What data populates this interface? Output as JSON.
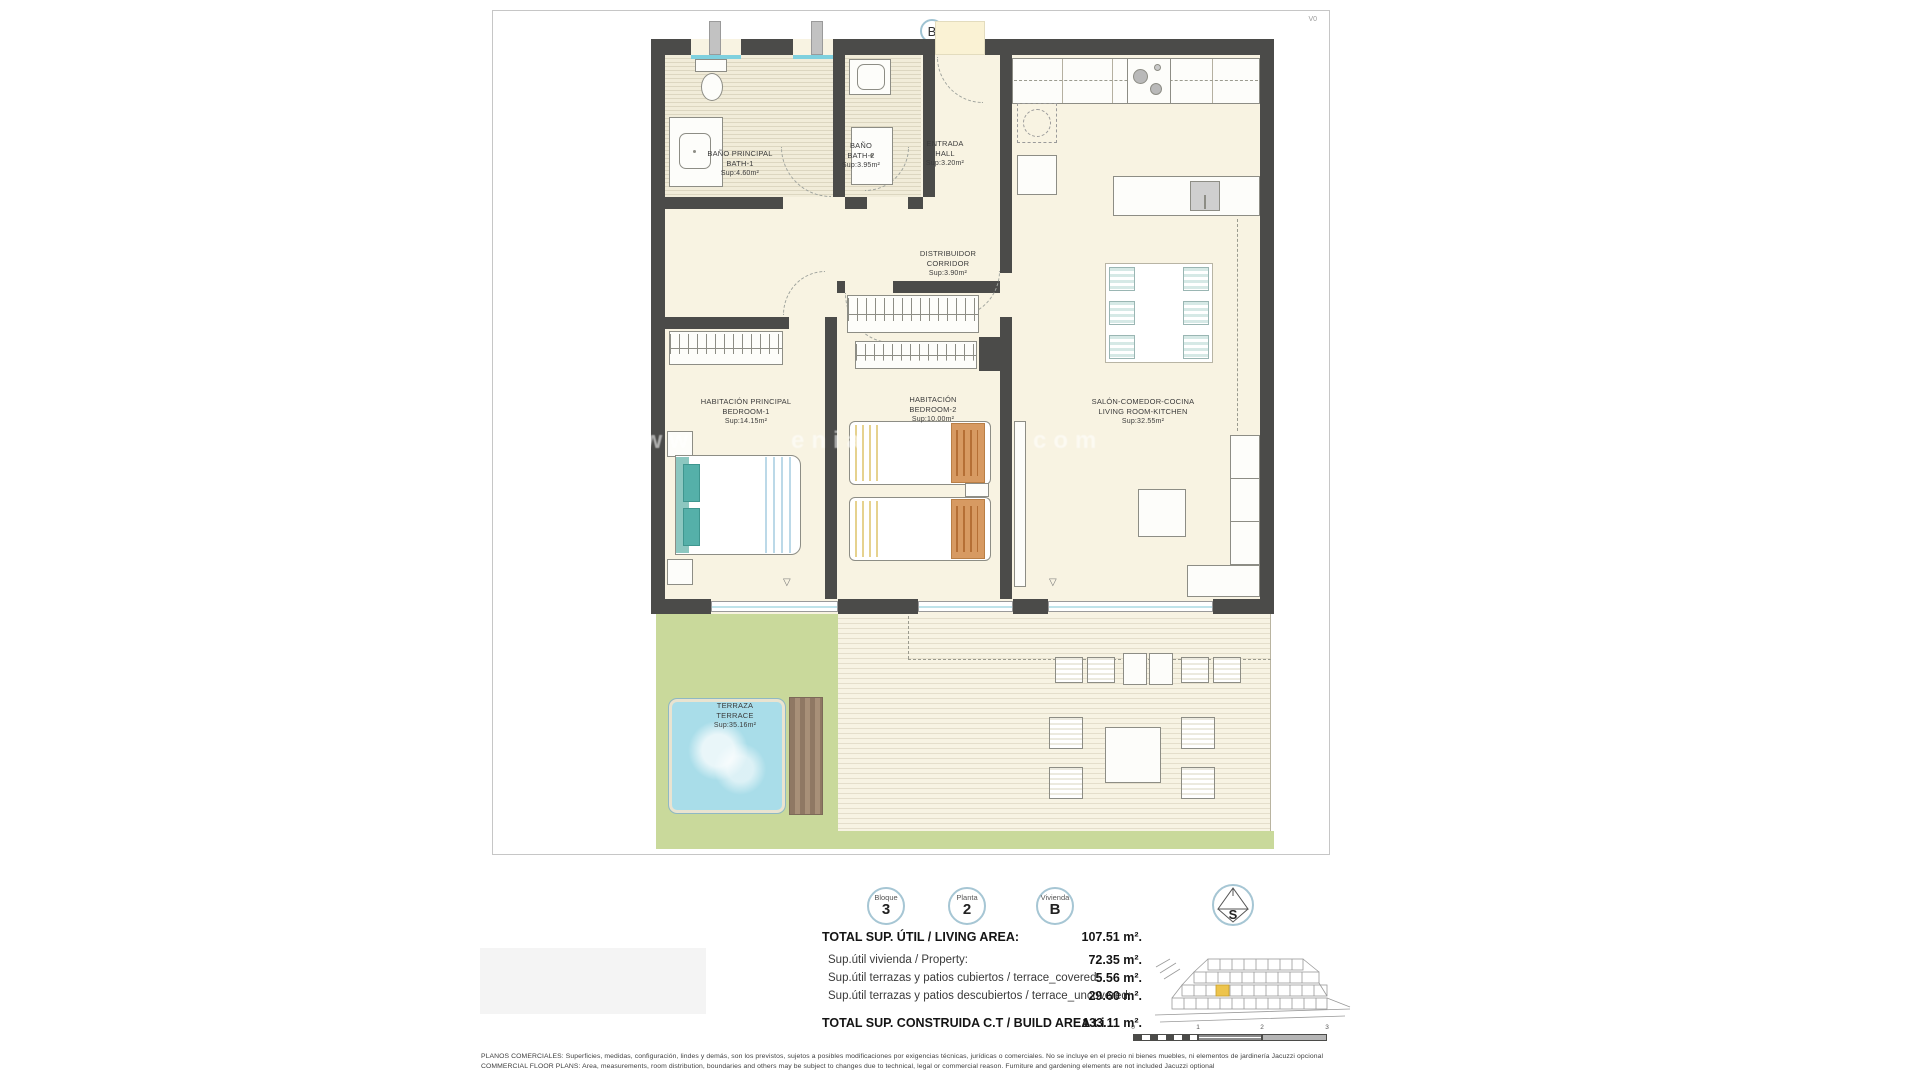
{
  "sheet": {
    "unit_letter": "B",
    "version": "V0"
  },
  "rooms": {
    "bath1": {
      "es": "BAÑO PRINCIPAL",
      "en": "BATH-1",
      "sup": "Sup:4.60m²"
    },
    "bath2": {
      "es": "BAÑO",
      "en": "BATH-2",
      "sup": "Sup:3.95m²"
    },
    "hall": {
      "es": "ENTRADA",
      "en": "HALL",
      "sup": "Sup:3.20m²"
    },
    "corridor": {
      "es": "DISTRIBUIDOR",
      "en": "CORRIDOR",
      "sup": "Sup:3.90m²"
    },
    "bedroom1": {
      "es": "HABITACIÓN PRINCIPAL",
      "en": "BEDROOM-1",
      "sup": "Sup:14.15m²"
    },
    "bedroom2": {
      "es": "HABITACIÓN",
      "en": "BEDROOM-2",
      "sup": "Sup:10.00m²"
    },
    "living": {
      "es": "SALÓN-COMEDOR-COCINA",
      "en": "LIVING ROOM-KITCHEN",
      "sup": "Sup:32.55m²"
    },
    "terrace": {
      "es": "TERRAZA",
      "en": "TERRACE",
      "sup": "Sup:35.16m²"
    }
  },
  "watermark": {
    "fragments": [
      "www",
      "enia",
      "com"
    ]
  },
  "badges": {
    "bloque": {
      "label": "Bloque",
      "value": "3"
    },
    "planta": {
      "label": "Planta",
      "value": "2"
    },
    "vivienda": {
      "label": "Vivienda",
      "value": "B"
    }
  },
  "compass": {
    "letter": "S"
  },
  "summary": {
    "rows": [
      {
        "label": "TOTAL SUP. ÚTIL / LIVING AREA:",
        "value": "107.51 m²."
      },
      {
        "label": "Sup.útil vivienda / Property:",
        "value": "72.35 m²."
      },
      {
        "label": "Sup.útil terrazas y patios cubiertos / terrace_covered:",
        "value": "5.56 m²."
      },
      {
        "label": "Sup.útil terrazas y patios descubiertos / terrace_uncovered:",
        "value": "29.60 m²."
      }
    ],
    "total_label": "TOTAL SUP. CONSTRUIDA C.T / BUILD AREA t.i :",
    "total_value": "133.11 m²."
  },
  "scalebar": {
    "ticks": [
      "0",
      "1",
      "2",
      "3"
    ]
  },
  "disclaimer": {
    "line1": "PLANOS COMERCIALES: Superficies, medidas, configuración, lindes y demás, son los previstos, sujetos a posibles modificaciones por exigencias técnicas, jurídicas o comerciales. No se incluye en el precio ni bienes muebles, ni elementos de jardinería Jacuzzi opcional",
    "line2": "COMMERCIAL FLOOR PLANS: Area, measurements, room distribution, boundaries and others may be subject to changes due to technical, legal or commercial reason. Furniture and gardening elements are not included Jacuzzi optional"
  },
  "colors": {
    "wall": "#4b4b49",
    "floor": "#f8f3e2",
    "accent_blue": "#a6c6d4",
    "lawn": "#c9d99b",
    "pool": "#a9dde9",
    "deck_wood": "#a28a73",
    "highlight_unit": "#edc44c"
  }
}
